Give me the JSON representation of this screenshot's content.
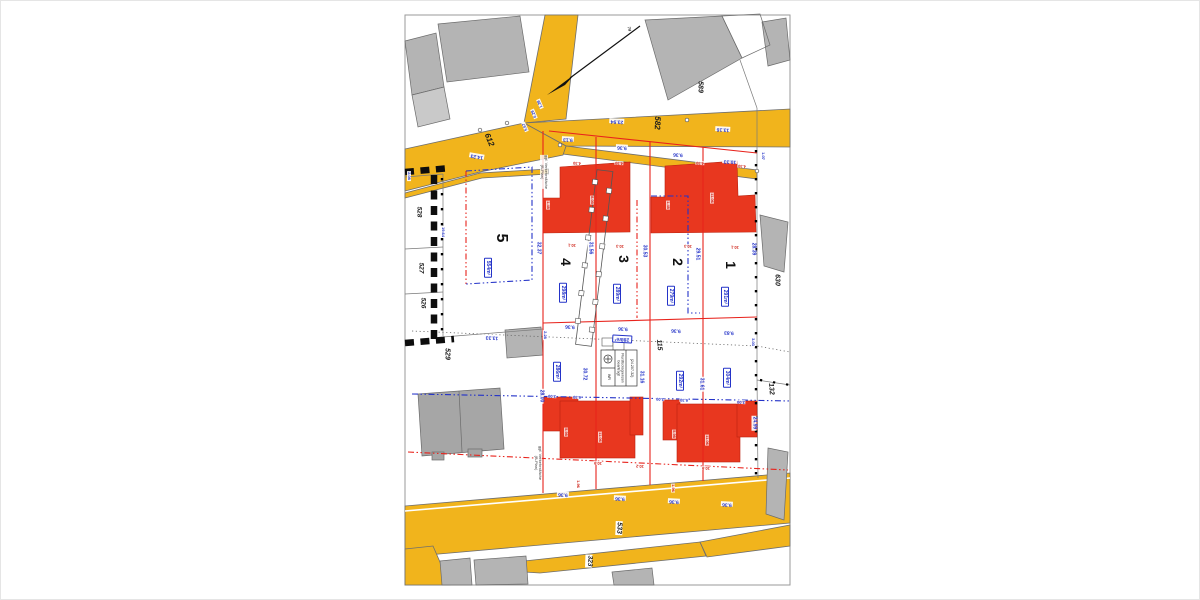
{
  "colors": {
    "road": "#f1b41c",
    "new_building": "#e8371f",
    "existing_building": "#b4b4b4",
    "parcel_line_red": "#e8231c",
    "dimension_blue": "#2433c8"
  },
  "ids": {
    "road_nw": "612",
    "road_n": "582",
    "ne": "589",
    "pt74": "74",
    "e": "630",
    "se": "132",
    "mid": "115",
    "w": "529",
    "w528": "528",
    "w527": "527",
    "w526": "526",
    "road_s": "533",
    "s": "323"
  },
  "plots": {
    "p5": "5",
    "p4": "4",
    "p3": "3",
    "p2": "2",
    "p1": "1"
  },
  "areas": {
    "a5": "554m²",
    "a4": "298m²",
    "a3": "289m²",
    "a2": "279m²",
    "a1": "291m²",
    "b1": "286m²",
    "b2": "288m²",
    "b3": "292m²",
    "b4": "304m²"
  },
  "dims": {
    "n1": "23.94",
    "n2": "13.16",
    "nw": "14.23",
    "nwa": "5.67",
    "nwb": "0.29",
    "nwc": "1.39",
    "w": "2.08",
    "t1": "9.13",
    "t2": "9.36",
    "t3": "9.36",
    "t4": "10.33",
    "e": "1.07",
    "v5": "32.37",
    "v4": "31.56",
    "v3": "30.53",
    "v2": "29.51",
    "v1": "28.39",
    "m1": "9.36",
    "m2": "9.36",
    "m3": "9.36",
    "m4": "9.83",
    "ml": "2.28",
    "mr": "3.03",
    "wl": "13.33",
    "wv": "19.64",
    "lowl": "28.00",
    "lv1": "30.72",
    "lv2": "31.16",
    "lv3": "31.61",
    "lowr": "24.99",
    "s1": "9.36",
    "s2": "9.36",
    "s3": "9.36",
    "s4": "9.36",
    "bl1": "3.00",
    "bl2": "6.30",
    "bl3": "2.00",
    "bl4": "6.30",
    "bl5": "3.00"
  },
  "bdims": {
    "a": "4.30",
    "b": "4.30",
    "c": "4.30",
    "d": "4.30",
    "e": "1.48",
    "f": "8.05",
    "g": "11.06",
    "h": "1.48",
    "i": "10.1",
    "j": "10.3",
    "k": "10.3",
    "l": "10.1",
    "m": "5.98",
    "n": "11.06",
    "o": "5.98",
    "p": "11.06",
    "q": "10.9",
    "r": "10.2",
    "s": "10.9",
    "t": "1.96",
    "u": "1.96"
  },
  "notes": {
    "traffic": "ggf. Verkehrsfläche\n(B-Plan)"
  },
  "legend": {
    "wr": "WR",
    "t1": "Flurstücksgrenzen\nbeantragt",
    "t2": "(24.207-32)"
  }
}
